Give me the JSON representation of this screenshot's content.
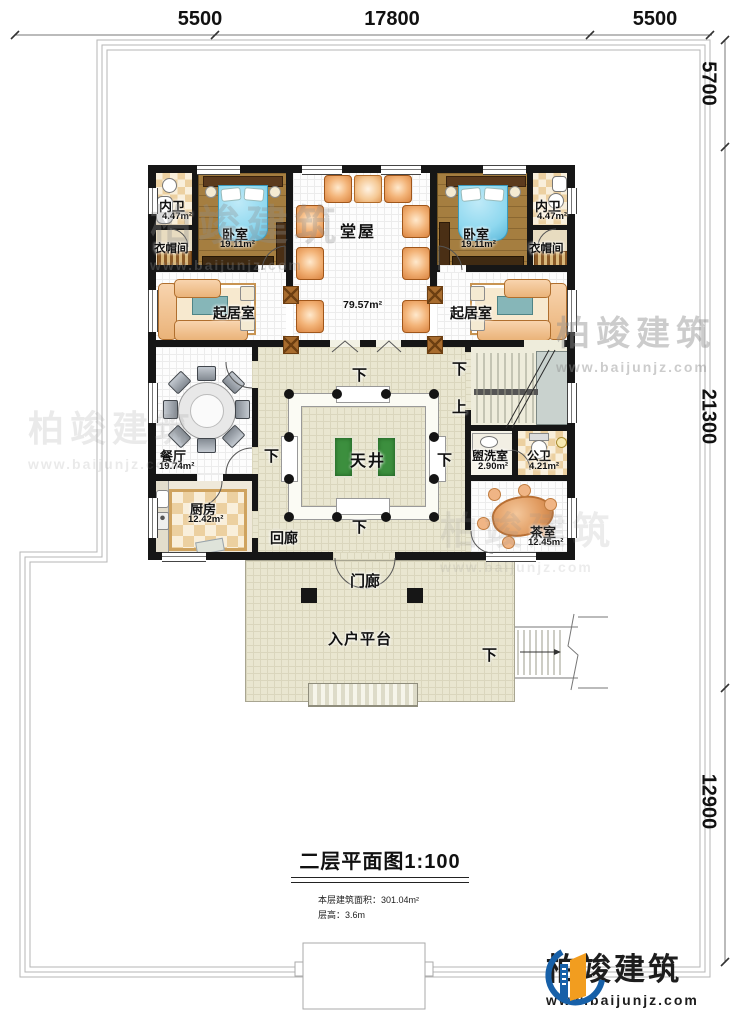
{
  "dimensions": {
    "top": [
      "5500",
      "17800",
      "5500"
    ],
    "right": [
      "5700",
      "21300",
      "12900"
    ]
  },
  "labels": {
    "down": "下",
    "up": "上"
  },
  "rooms": {
    "neiwei_l": {
      "name": "内卫",
      "area": "4.47m²"
    },
    "bedroom_l": {
      "name": "卧室",
      "area": "19.11m²"
    },
    "cloak_l": {
      "name": "衣帽间"
    },
    "hall": {
      "name": "堂屋"
    },
    "open": {
      "area": "79.57m²"
    },
    "bedroom_r": {
      "name": "卧室",
      "area": "19.11m²"
    },
    "neiwei_r": {
      "name": "内卫",
      "area": "4.47m²"
    },
    "cloak_r": {
      "name": "衣帽间"
    },
    "living_l": {
      "name": "起居室"
    },
    "living_r": {
      "name": "起居室"
    },
    "dining": {
      "name": "餐厅",
      "area": "19.74m²"
    },
    "kitchen": {
      "name": "厨房",
      "area": "12.42m²"
    },
    "courtyard": {
      "name": "天井"
    },
    "cloister": {
      "name": "回廊"
    },
    "washroom": {
      "name": "盥洗室",
      "area": "2.90m²"
    },
    "wc": {
      "name": "公卫",
      "area": "4.21m²"
    },
    "tearoom": {
      "name": "茶室",
      "area": "12.45m²"
    },
    "porch": {
      "name": "门廊"
    },
    "platform": {
      "name": "入户平台"
    }
  },
  "title": {
    "main": "二层平面图",
    "scale": "1:100",
    "line1": "本层建筑面积：301.04m²",
    "line2": "层高：3.6m"
  },
  "brand": {
    "name": "柏竣建筑",
    "url": "www.baijunjz.com"
  },
  "colors": {
    "wall": "#161616",
    "wood": "#a57e40",
    "cream": "#e9e6d0",
    "bed": "#8fd8ef",
    "accentOrange": "#f29d1f",
    "accentBlue": "#1760a8"
  }
}
